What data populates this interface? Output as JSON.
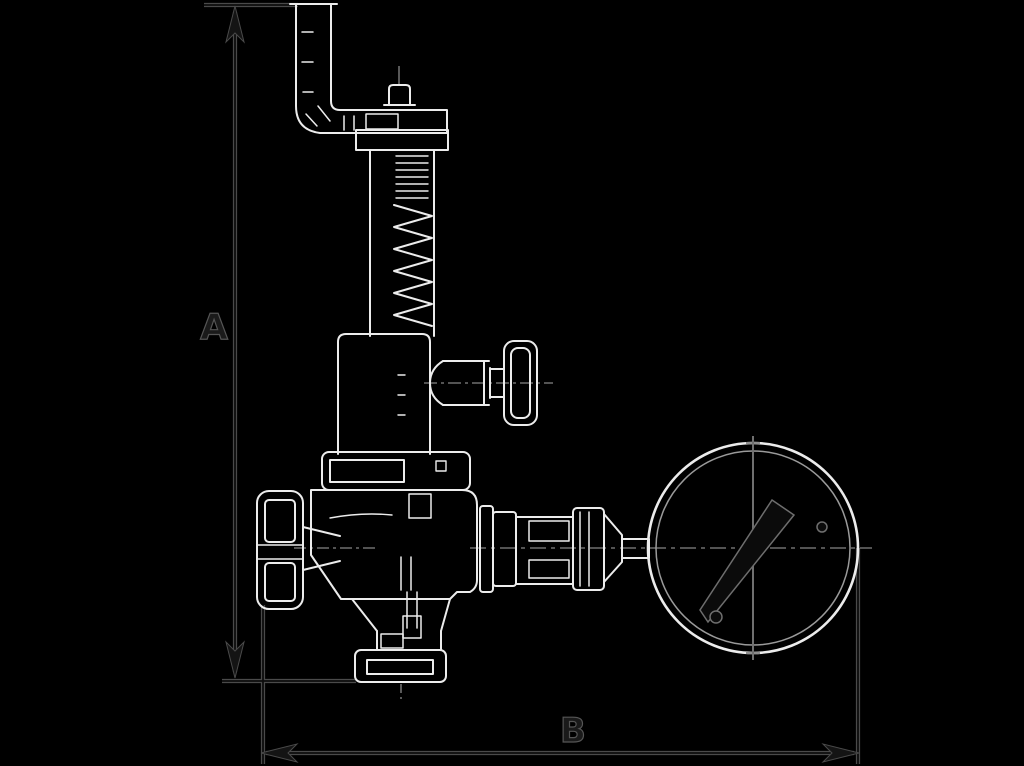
{
  "labels": {
    "dimension_a": "A",
    "dimension_b": "B"
  },
  "colors": {
    "background": "#000000",
    "primary_linework": "#ececec",
    "secondary_linework": "#9a9a9a",
    "centerline": "#6f6f6f",
    "dimension_halo": "#4a4a4a",
    "dimension_core": "#0d0d0d",
    "label_fill": "#1a1a1a",
    "label_halo": "#555555"
  },
  "drawing": {
    "type": "technical-drawing",
    "components": [
      "lever-arm",
      "stem-cap",
      "spring-housing",
      "spring",
      "test-gauge-valve",
      "bonnet-flange",
      "valve-body",
      "handwheel",
      "outlet-funnel",
      "bottom-flange",
      "outlet-piping",
      "pressure-gauge",
      "gauge-needle"
    ]
  }
}
